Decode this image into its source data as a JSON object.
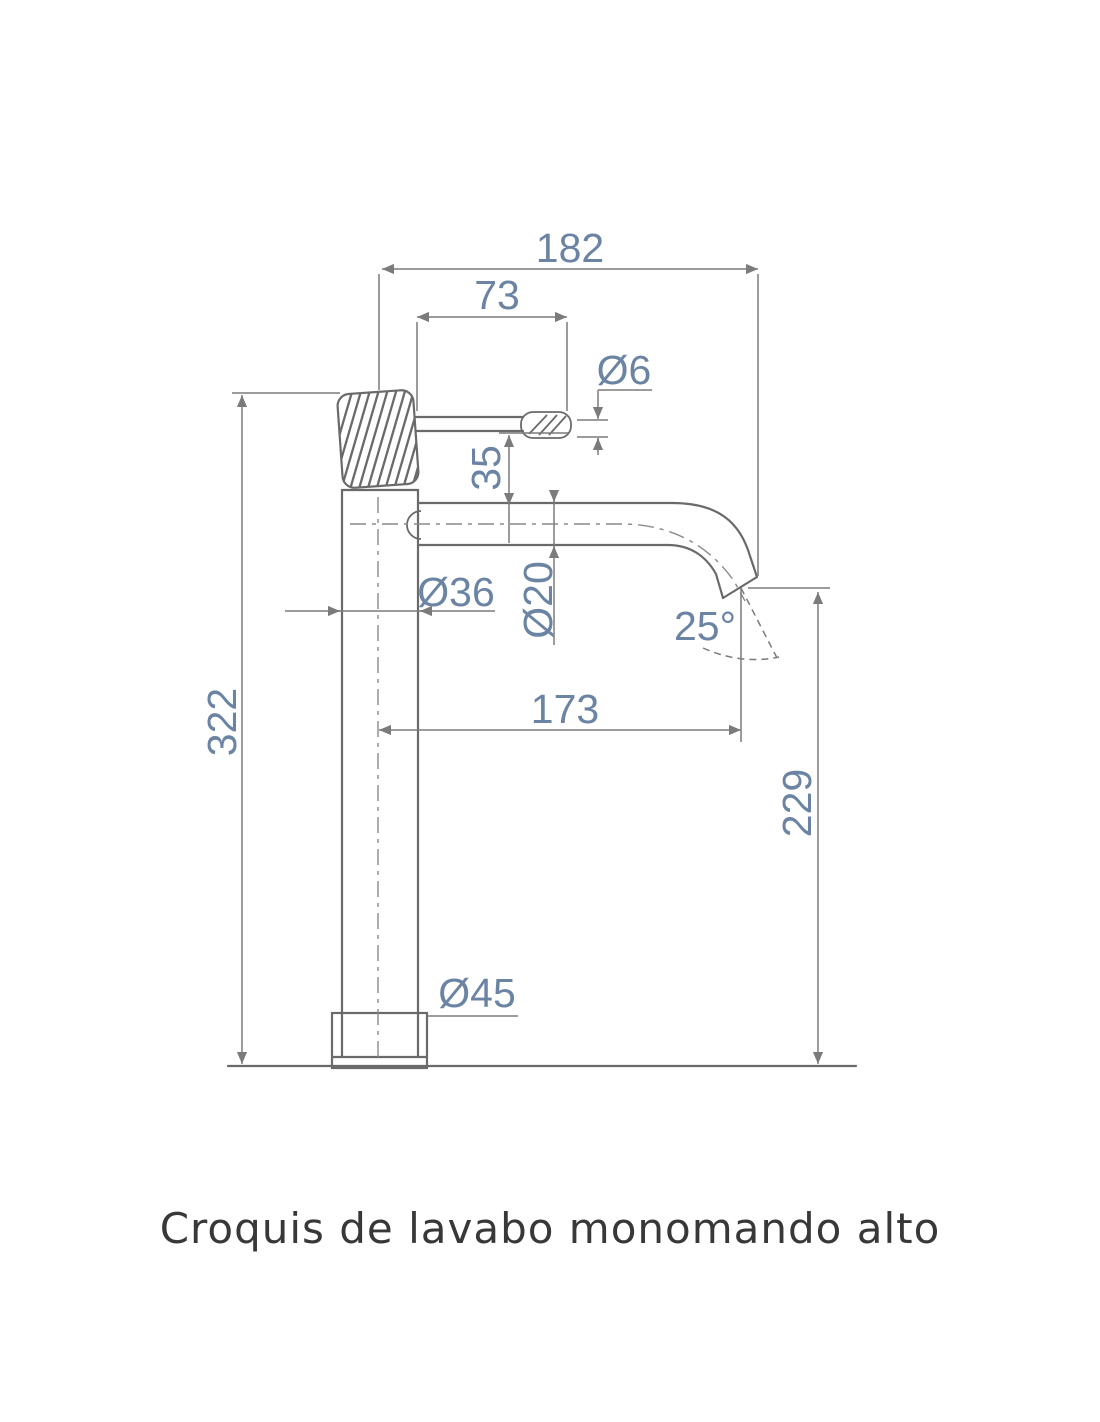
{
  "caption": "Croquis de lavabo monomando alto",
  "dimensions": {
    "overall_width": "182",
    "handle_length": "73",
    "handle_tip_diameter": "Ø6",
    "handle_to_spout": "35",
    "body_diameter": "Ø36",
    "spout_tube_diameter": "Ø20",
    "spout_angle": "25°",
    "spout_reach": "173",
    "total_height": "322",
    "outlet_height": "229",
    "base_diameter": "Ø45"
  },
  "colors": {
    "line": "#6a6a6a",
    "dimension_line": "#7b7b7b",
    "dimension_text": "#6b84a4",
    "caption_text": "#383838",
    "background": "#ffffff"
  }
}
